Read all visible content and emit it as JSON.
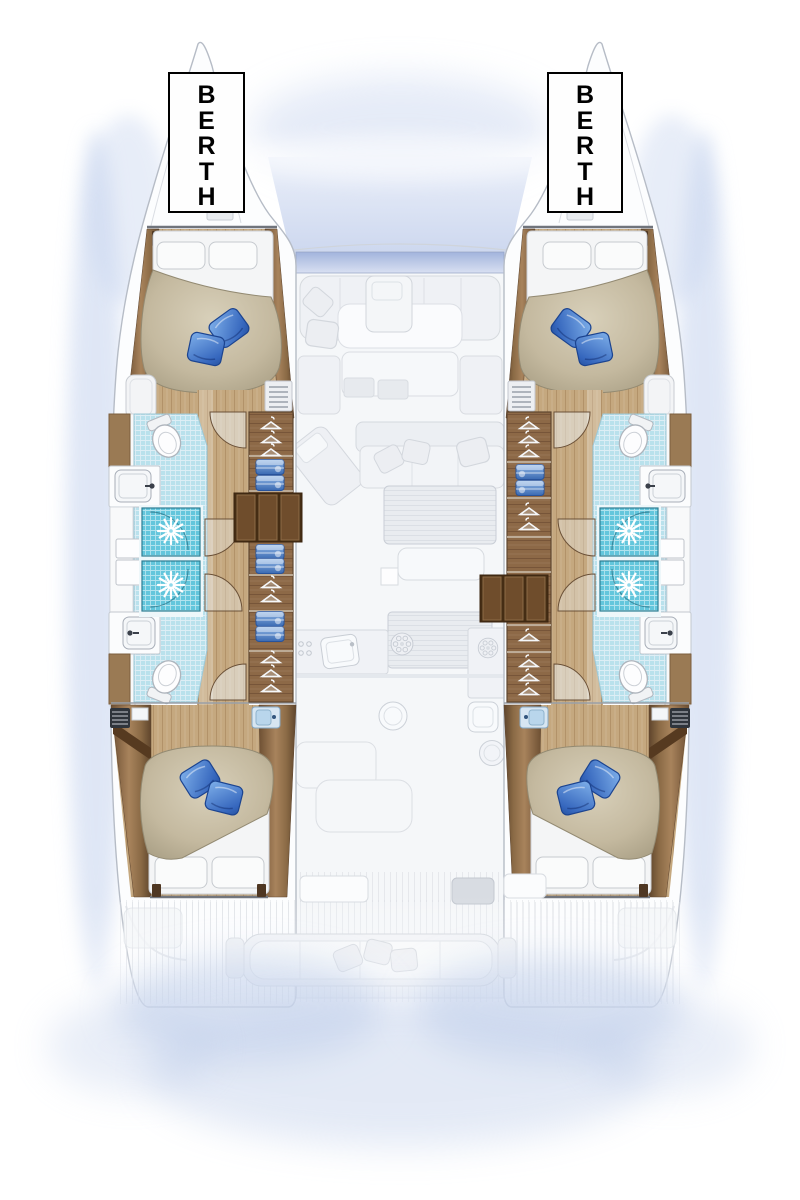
{
  "labels": {
    "berth_port": "BERTH",
    "berth_starboard": "BERTH"
  },
  "palette": {
    "pillow_blue": "#3566bd",
    "duvet_beige": "#c4b99f",
    "wood_rail": "#8a6a45",
    "wood_floor": "#c5a87f",
    "wardrobe_wood": "#8d6947",
    "tile_blue": "#b9e1ec",
    "shower_blue": "#63c6dc",
    "towel_blue": "#3a6ab2",
    "ghost_gray": "#e9ecf0",
    "shadow_blue": "#c5d3ee",
    "label_border": "#000000"
  },
  "icons": {
    "toilet": "toilet-icon",
    "sink": "sink-icon",
    "shower_drain": "shower-drain-icon",
    "clothes_hanger": "hanger-icon",
    "towel": "towel-icon",
    "stove_burner": "burner-icon",
    "vent_grille": "vent-grille-icon"
  }
}
